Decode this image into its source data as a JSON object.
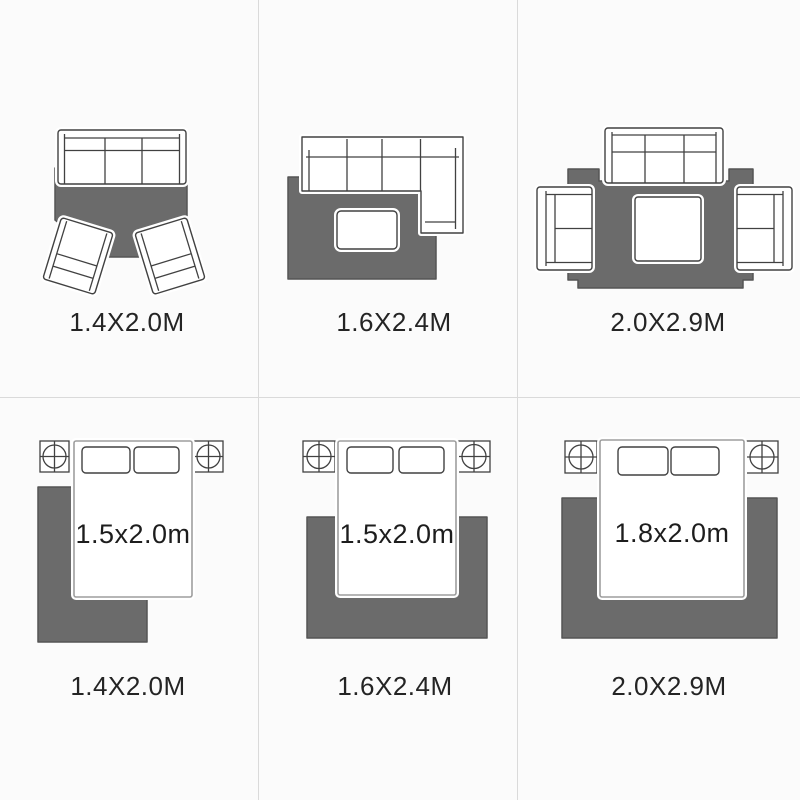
{
  "sections": {
    "living_room_layouts": [
      {
        "rug_size": "1.4X2.0M"
      },
      {
        "rug_size": "1.6X2.4M"
      },
      {
        "rug_size": "2.0X2.9M"
      }
    ],
    "bedroom_layouts": [
      {
        "rug_size": "1.4X2.0M",
        "bed_size": "1.5x2.0m"
      },
      {
        "rug_size": "1.6X2.4M",
        "bed_size": "1.5x2.0m"
      },
      {
        "rug_size": "2.0X2.9M",
        "bed_size": "1.8x2.0m"
      }
    ]
  },
  "colors": {
    "background": "#fbfbfb",
    "rug_fill": "#6b6b6b",
    "rug_outline": "#555555",
    "furniture_outline": "#414141",
    "bed_outline": "#9e9e9e",
    "grid_line": "#dadada",
    "label_text": "#242424",
    "bed_label_text": "#1d1d1d"
  },
  "icons": [
    "sofa-icon",
    "sectional-sofa-icon",
    "armchair-icon",
    "loveseat-icon",
    "coffee-table-icon",
    "bed-icon",
    "pillow-icon",
    "nightstand-lamp-icon",
    "rug-shape"
  ]
}
